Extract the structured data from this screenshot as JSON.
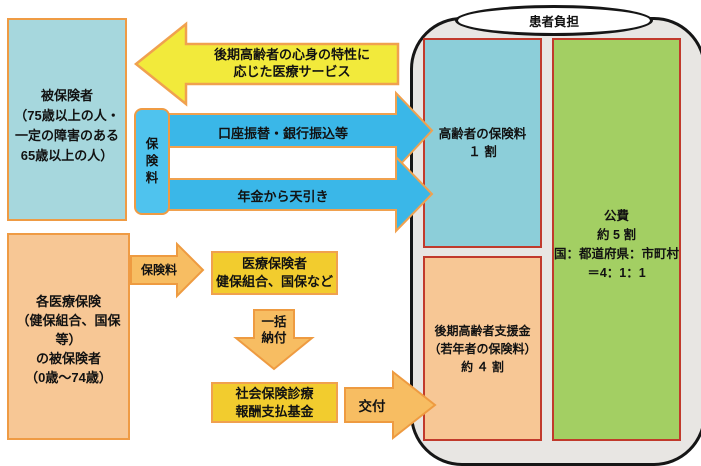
{
  "diagram": {
    "title_semantic": "後期高齢者医療制度の財政のしくみ",
    "insured_box": "被保険者\n（75歳以上の人・\n一定の障害のある\n65歳以上の人）",
    "each_insurance_box": "各医療保険\n（健保組合、国保等）\nの被保険者\n（0歳～74歳）",
    "premium_box_vertical": "保\n険\n料",
    "medical_service_arrow": "後期高齢者の心身の特性に\n応じた医療サービス",
    "bank_transfer_arrow": "口座振替・銀行振込等",
    "pension_arrow": "年金から天引き",
    "premium_arrow": "保険料",
    "insurer_box": "医療保険者\n健保組合、国保など",
    "lump_sum_arrow": "一括\n納付",
    "payment_fund_box": "社会保険診療\n報酬支払基金",
    "grant_arrow": "交付",
    "patient_burden": "患者負担",
    "elderly_premium_box": "高齢者の保険料\n１ 割",
    "support_fund_box": "後期高齢者支援金\n（若年者の保険料）\n約 ４ 割",
    "public_funds_box": "公費\n約 5 割\n国：都道府県：市町村\n＝4：1：1"
  },
  "colors": {
    "light_blue_box": "#a6d7dd",
    "peach_box": "#f7c795",
    "gold_box": "#f2cc2e",
    "green_box": "#a3cf63",
    "panel_gray": "#e8e6e3",
    "yellow_arrow": "#f2ea3b",
    "blue_arrow": "#3ab7e8",
    "premium_blue_box": "#4fc3ee",
    "orange_arrow": "#f7bd62",
    "orange_border": "#ef9b44",
    "red_border": "#c13a2c",
    "black_border": "#161616"
  }
}
